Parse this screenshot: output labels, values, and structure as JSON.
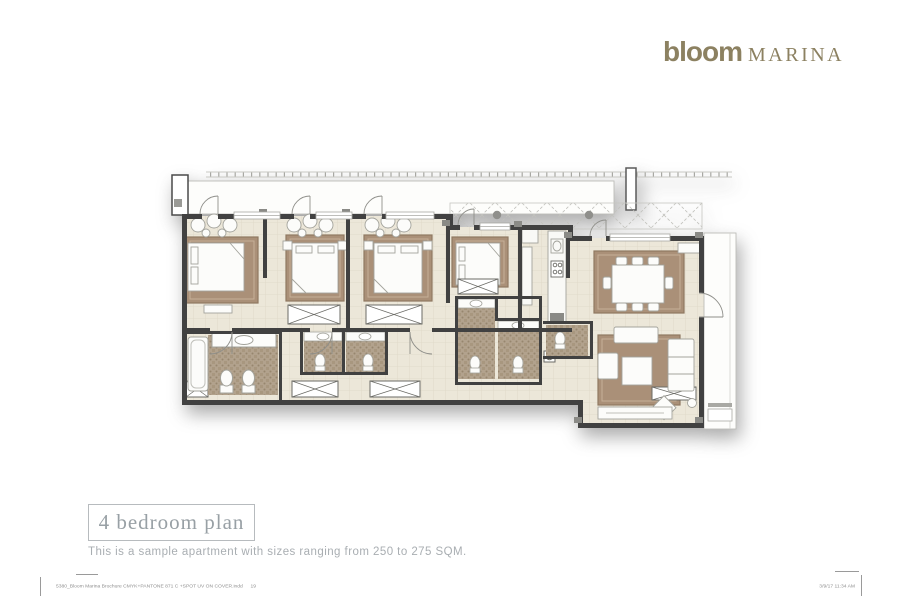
{
  "logo": {
    "wordmark": "bloom",
    "suffix": "MARINA",
    "color": "#8C8161"
  },
  "plan": {
    "title": "4 bedroom plan",
    "subtitle": "This is a sample apartment with sizes ranging from 250 to 275 SQM.",
    "colors": {
      "wall": "#414141",
      "floor_tile": "#ECE7D9",
      "rug": "#AA9078",
      "bathroom_mosaic": "#B2A28D",
      "furniture": "#FCFCFA",
      "balcony_outline": "#BDBDB8"
    }
  },
  "footer": {
    "left_text": "5380_Bloom Marina Brochure CMYK+PANTONE 871 C +SPOT UV ON COVER.indd",
    "page_number": "19",
    "right_text": "3/9/17   11:34 AM"
  }
}
